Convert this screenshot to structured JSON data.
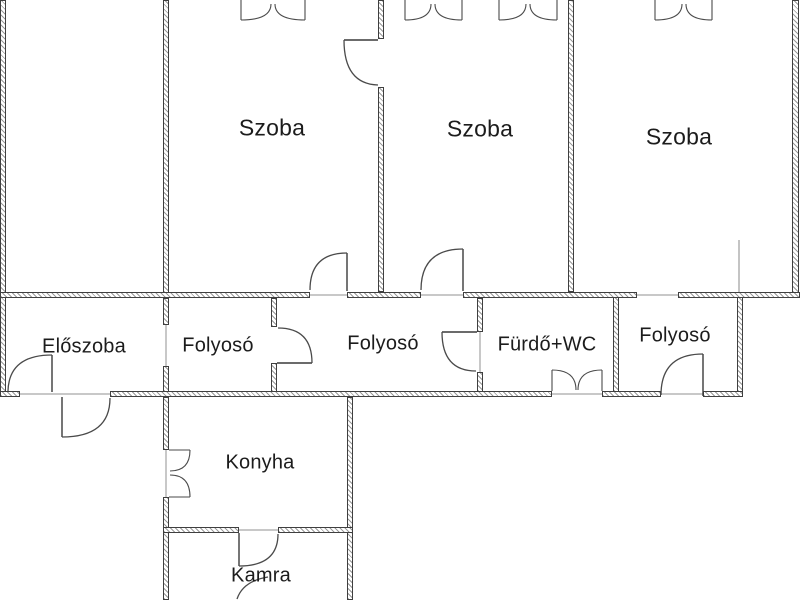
{
  "drawing": {
    "kind": "apartment floor plan",
    "language": "Hungarian",
    "background": "#ffffff"
  },
  "colors": {
    "wall_outline": "#3f3f3f",
    "wall_hatch": "#9a9a9a",
    "door_line": "#4a4a4a",
    "label_text": "#1c1c1c"
  },
  "rooms": [
    {
      "id": "szoba-1",
      "label": "Szoba",
      "center": [
        272,
        128
      ]
    },
    {
      "id": "szoba-2",
      "label": "Szoba",
      "center": [
        480,
        129
      ]
    },
    {
      "id": "szoba-3",
      "label": "Szoba",
      "center": [
        679,
        137
      ]
    },
    {
      "id": "eloszoba",
      "label": "Előszoba",
      "center": [
        84,
        347
      ]
    },
    {
      "id": "folyoso-1",
      "label": "Folyosó",
      "center": [
        218,
        346
      ]
    },
    {
      "id": "folyoso-2",
      "label": "Folyosó",
      "center": [
        383,
        344
      ]
    },
    {
      "id": "furdo-wc",
      "label": "Fürdő+WC",
      "center": [
        547,
        345
      ]
    },
    {
      "id": "folyoso-3",
      "label": "Folyosó",
      "center": [
        675,
        336
      ]
    },
    {
      "id": "konyha",
      "label": "Konyha",
      "center": [
        260,
        463
      ]
    },
    {
      "id": "kamra",
      "label": "Kamra",
      "center": [
        261,
        576
      ]
    }
  ]
}
